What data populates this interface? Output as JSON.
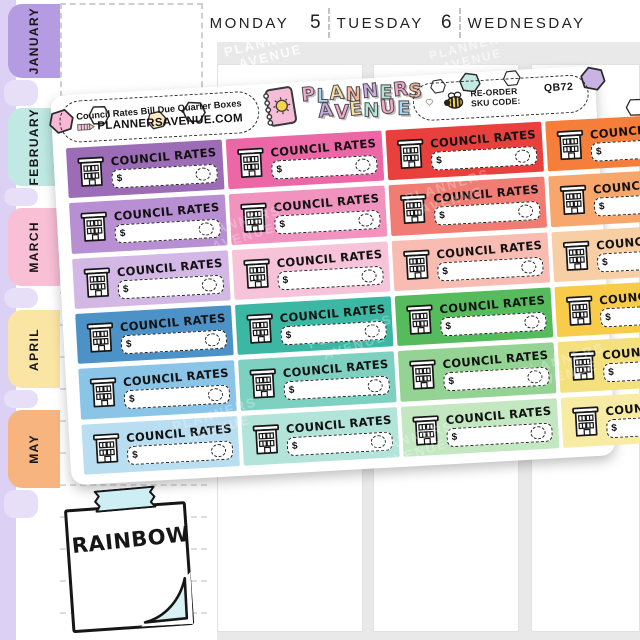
{
  "calendar": {
    "tabs": [
      {
        "label": "JANUARY",
        "color": "#b59ce2"
      },
      {
        "label": "FEBRUARY",
        "color": "#bfe9e2"
      },
      {
        "label": "MARCH",
        "color": "#f9c0d5"
      },
      {
        "label": "APRIL",
        "color": "#fbe5a5"
      },
      {
        "label": "MAY",
        "color": "#f7b47e"
      }
    ],
    "days": [
      {
        "number": "4",
        "name": "MONDAY"
      },
      {
        "number": "5",
        "name": "TUESDAY"
      },
      {
        "number": "6",
        "name": "WEDNESDAY"
      }
    ]
  },
  "sheet": {
    "product_label": "Council Rates Bill Due Quarter Boxes",
    "website": "PLANNERSAVENUE.COM",
    "reorder_line1": "RE-ORDER",
    "reorder_line2": "SKU CODE:",
    "sku": "QB72",
    "brand": {
      "line1": [
        [
          "P",
          "#f5a8cc"
        ],
        [
          "L",
          "#abd7f2"
        ],
        [
          "A",
          "#f8e0a8"
        ],
        [
          "N",
          "#f7b59c"
        ],
        [
          "N",
          "#ccabe5"
        ],
        [
          "E",
          "#b5e5d8"
        ],
        [
          "R",
          "#f5a8cc"
        ],
        [
          "S",
          "#f7b59c"
        ]
      ],
      "line2": [
        [
          "A",
          "#ccabe5"
        ],
        [
          "V",
          "#f5a8cc"
        ],
        [
          "E",
          "#f8e0a8"
        ],
        [
          "N",
          "#b5e5d8"
        ],
        [
          "U",
          "#f5a8cc"
        ],
        [
          "E",
          "#abd7f2"
        ]
      ]
    },
    "sticker": {
      "label": "COUNCIL RATES",
      "currency": "$"
    },
    "sticker_colors": [
      "#9c6db6",
      "#ec67a5",
      "#e8403d",
      "#f57f3a",
      "#b78fd2",
      "#f193bf",
      "#f07c73",
      "#f8a76c",
      "#d3b8e6",
      "#f7c3d9",
      "#f8bcb2",
      "#f8cfa4",
      "#4d92c7",
      "#3bb7a3",
      "#55bb5c",
      "#f8cc49",
      "#8ac4e7",
      "#7ed1c1",
      "#95d395",
      "#f5e07e",
      "#b9def1",
      "#b2e4d9",
      "#c3e8c1",
      "#f8eba3"
    ],
    "hex_decoration_fills": [
      "#f6b8d4",
      "#ffffff",
      "#f9e9c4",
      "#ffffff",
      "#ffffff",
      "#c6e9e4",
      "#ffffff",
      "#c9b2e4",
      "#ffffff"
    ]
  },
  "note": {
    "label": "RAINBOW"
  },
  "watermark": {
    "line1": "PLANNERS",
    "line2": "AVENUE"
  },
  "icons": {
    "building": "building-icon",
    "bee": "bee-icon",
    "heart": "heart-icon",
    "pencil": "pencil-icon",
    "notebook": "notebook-icon",
    "sun": "sun-icon",
    "hexagon": "hexagon-icon",
    "washi_tape": "washi-tape-icon",
    "page-fold": "page-fold-icon"
  }
}
